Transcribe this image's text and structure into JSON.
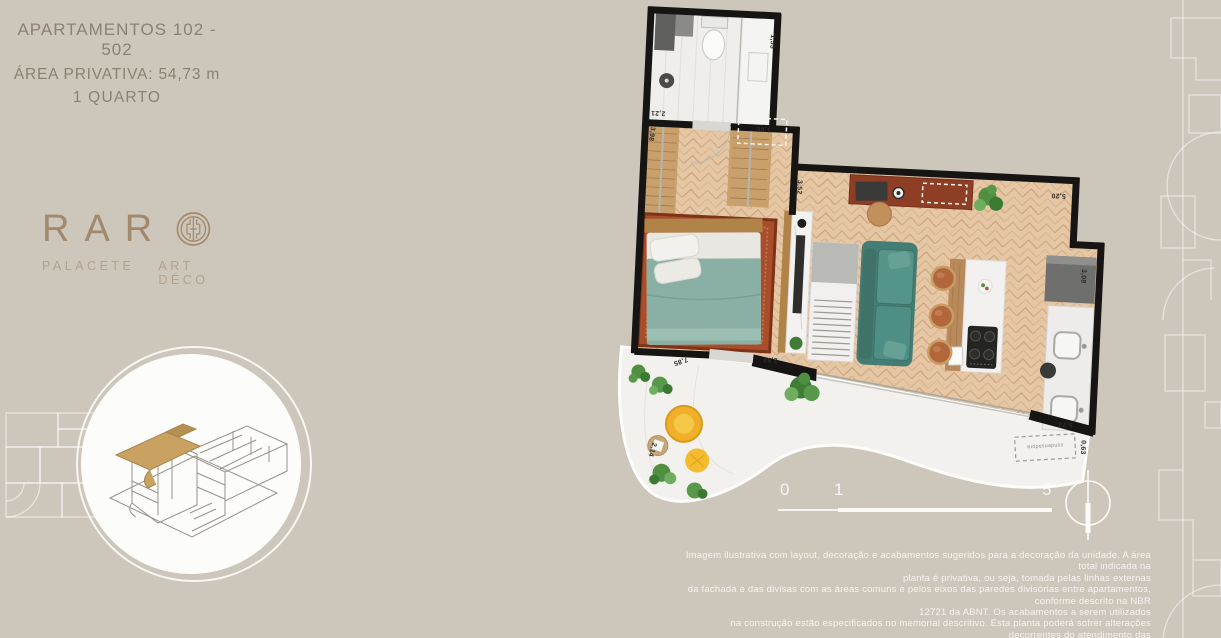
{
  "header": {
    "title": "APARTAMENTOS 102 - 502",
    "area": "ÁREA PRIVATIVA: 54,73 m",
    "rooms": "1 QUARTO"
  },
  "brand": {
    "name_prefix": "RAR",
    "name_suffix_glyph": "O",
    "tagline_left": "PALACETE",
    "tagline_right": "ART DÉCO"
  },
  "plan": {
    "labels": {
      "bath_width": "1,55",
      "bath_depth": "2,21",
      "bedroom_wall": "3,98",
      "entry_door": "1,66",
      "hall_depth": "3,52",
      "living_width": "5,20",
      "kitchen_depth": "3,08",
      "kitchen_width": "5,74",
      "condenser_width": "0,63",
      "condenser": "condensadora",
      "terrace_edge": "7,85",
      "terrace_side": "2,14",
      "bedroom_door": "2,92"
    }
  },
  "scale_bar": {
    "tick_0": "0",
    "tick_1": "1",
    "tick_5": "5"
  },
  "disclaimer": {
    "lines": [
      "Imagem ilustrativa com layout, decoração e acabamentos sugeridos para a decoração da unidade. A área total indicada na",
      "planta é privativa, ou seja, tomada pelas linhas externas",
      "da fachada e das divisas com as áreas comuns e pelos eixos das paredes divisórias entre apartamentos, conforme descrito na NBR",
      "12721 da ABNT. Os acabamentos a serem utilizados",
      "na construção estão especificados no memorial descritivo. Esta planta poderá sofrer alterações decorrentes do atendimento das",
      "posturas municipais, concessionárias e do local. Piscina, deck e churrasqueira não fazem parte do contrato."
    ]
  },
  "icons": {
    "north_indicator": "circle-with-vertical-line",
    "brand_o": "concentric-circles-with-greek-key"
  },
  "colors": {
    "background": "#cdc6ba",
    "wall": "#161513",
    "wood_floor": "#e5c7a5",
    "sofa_teal": "#4e8e84",
    "bed_teal": "#8ab0a5",
    "rug_terracotta": "#a84e2b",
    "armchair_yellow": "#f0b02a",
    "deck_white": "#f2f1ee",
    "brand_taupe": "#a2886d",
    "title_gray": "#8b8173",
    "disclaimer_white": "#fbfaf7"
  }
}
